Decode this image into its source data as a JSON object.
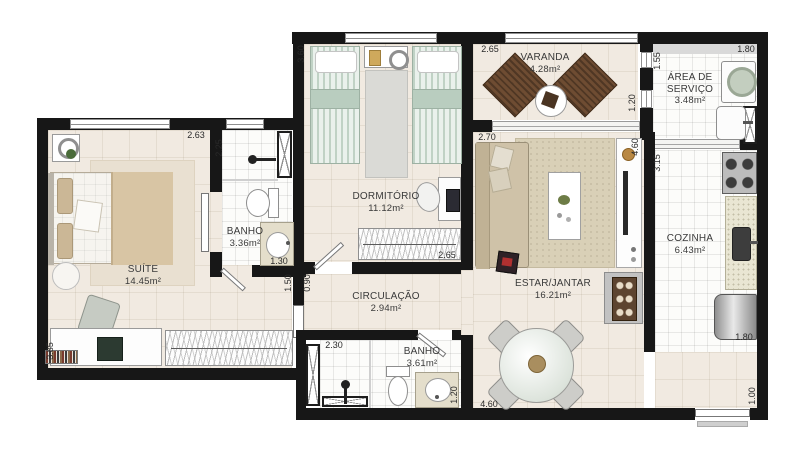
{
  "plan_title": "apartment-floor-plan",
  "rooms": {
    "suite": {
      "name": "SUÍTE",
      "area": "14.45m²"
    },
    "banho1": {
      "name": "BANHO",
      "area": "3.36m²"
    },
    "dormitorio": {
      "name": "DORMITÓRIO",
      "area": "11.12m²"
    },
    "varanda": {
      "name": "VARANDA",
      "area": "4.28m²"
    },
    "area_servico": {
      "name": "ÁREA DE SERVIÇO",
      "area": "3.48m²"
    },
    "cozinha": {
      "name": "COZINHA",
      "area": "6.43m²"
    },
    "estar_jantar": {
      "name": "ESTAR/JANTAR",
      "area": "16.21m²"
    },
    "circulacao": {
      "name": "CIRCULAÇÃO",
      "area": "2.94m²"
    },
    "banho2": {
      "name": "BANHO",
      "area": "3.61m²"
    }
  },
  "dimensions": [
    "2.63",
    "2.25",
    "3.60",
    "2.65",
    "2.65",
    "1.55",
    "1.20",
    "1.80",
    "3.15",
    "2.70",
    "4.60",
    "1.30",
    "1.50",
    "0.90",
    "2.30",
    "1.20",
    "4.60",
    "1.80",
    "1.00",
    "3.85"
  ],
  "colors": {
    "wall": "#171717",
    "floor_dry": "#f1eae1",
    "floor_wet": "#fcfcfa",
    "bed_mint": "#eaf1ec",
    "wood_brown": "#6e4c32",
    "counter_granite": "#e9e6d3"
  }
}
